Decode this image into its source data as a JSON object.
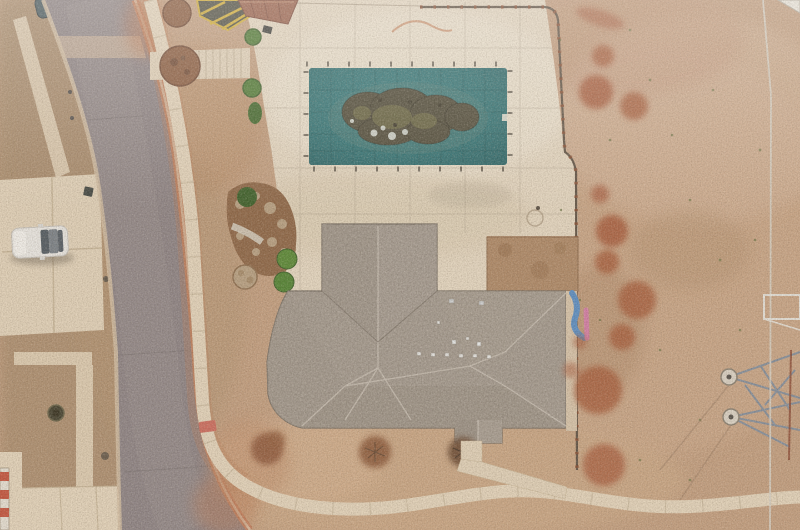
{
  "scene": {
    "type": "aerial-drone-photograph",
    "setting": "overhead view of a suburban house with a tarp-covered swimming pool, large concrete pool patio, dormant tan lawn with red clay patches, and a curved asphalt street",
    "objects": {
      "street": "curved asphalt residential street",
      "pool": "rectangular teal safety cover over free-form pool with dark leaf debris",
      "patio": "large cream concrete pool deck with expansion joints",
      "house": "hip-roofed house with taupe composite shingles and roof vents",
      "front_yard": "dormant tan grass with bare shrub patches",
      "east_lawn": "dry lawn with red dirt spots and transmission tower footings",
      "white_car": "white sedan parked on neighbor driveway",
      "teal_car": "dark teal car at top edge of frame",
      "slide": "blue playground slide beside east wall",
      "hazard_pad": "yellow striped utility pad near street",
      "fence": "dark wrought metal fence around pool patio"
    }
  },
  "colors": {
    "asphalt": "#8e8486",
    "curb": "#c5805f",
    "sidewalk": "#e6d6bd",
    "concrete": "#e4d4bb",
    "patio": "#e7d9c3",
    "pool_teal": "#2e7173",
    "pool_debris": "#4e4937",
    "debris_olive": "#6e6b43",
    "roof": "#a79d92",
    "roof_ridge": "#c8bfb4",
    "lawn_base": "#c5a081",
    "lawn_west": "#ad8f70",
    "dirt_red": "#a85a3a",
    "bare_dirt": "#b08a68",
    "mulch": "#8a5a3d",
    "bed_soil": "#8f6747",
    "shrub": "#4e7a33",
    "stone": "#b9a183",
    "fence": "#5f5143",
    "fence_rust": "#8a4c30",
    "car_white": "#eceae6",
    "car_glass": "#515a62",
    "car_teal": "#44565c",
    "slide_blue": "#5b8fc6",
    "slide_pink": "#d67fa8",
    "safety_yellow": "#d4af37",
    "red_mat": "#cf6d5f",
    "tower_strut": "#7d8da0",
    "line_white": "#d9d3c6",
    "neighbor_roof": "#9a604a",
    "stripe_red": "#c6543e"
  }
}
